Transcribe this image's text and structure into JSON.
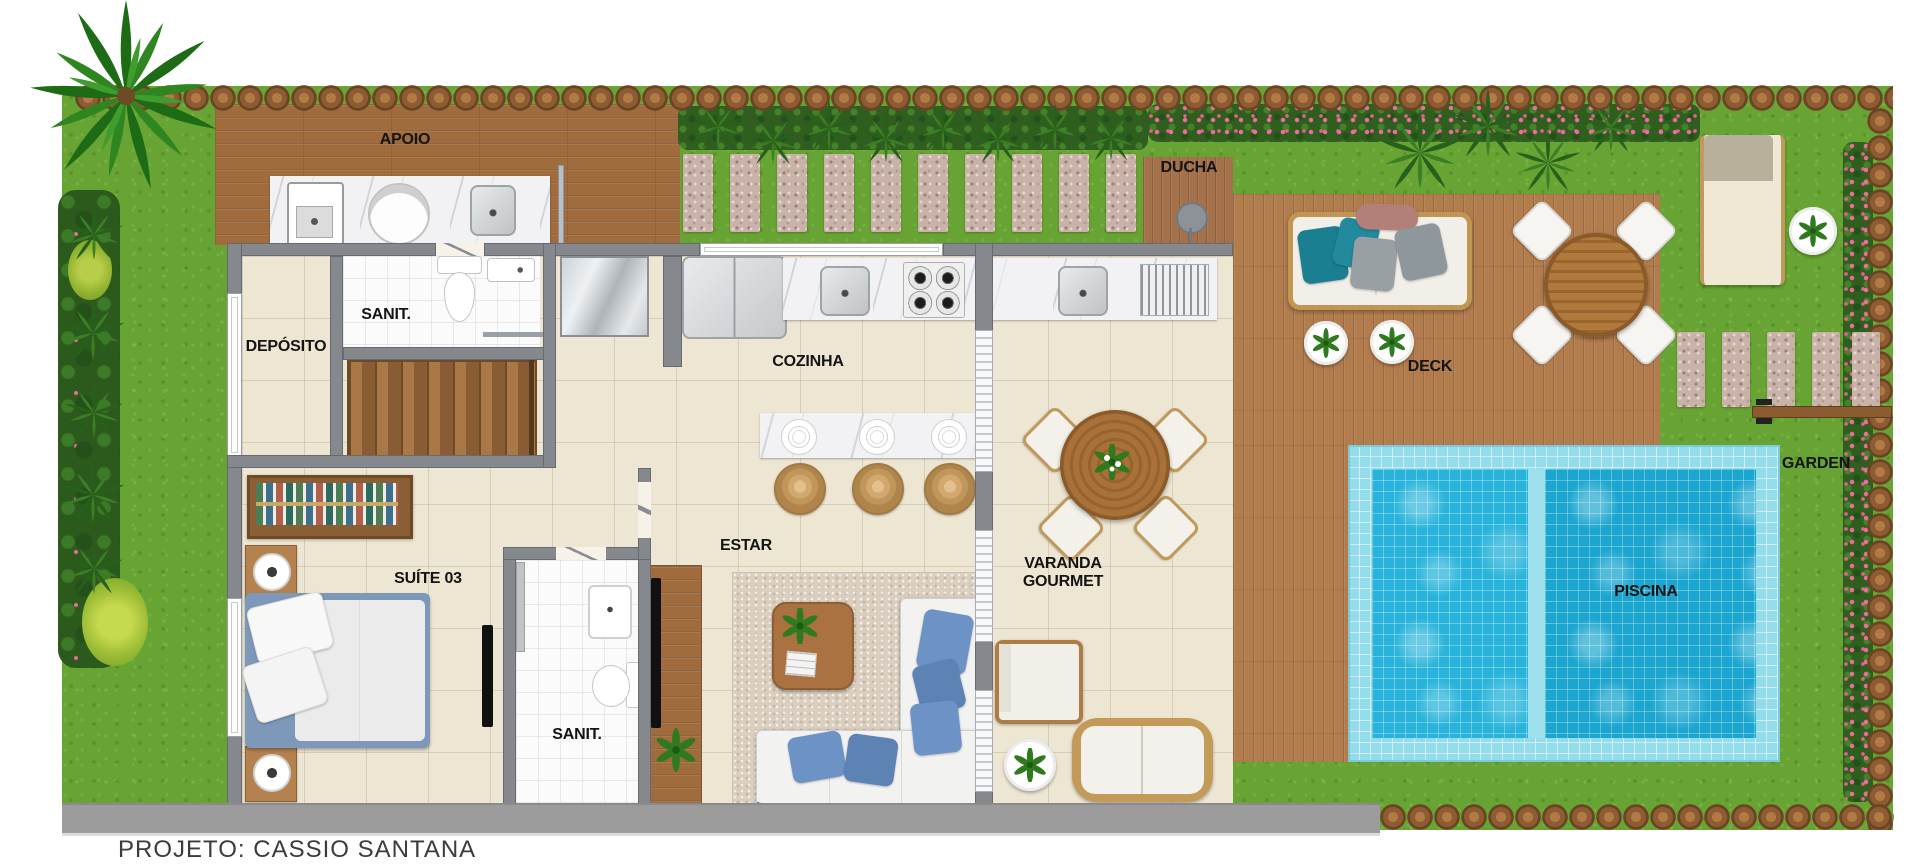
{
  "labels": {
    "apoio": "APOIO",
    "ducha": "DUCHA",
    "sanit_service": "SANIT.",
    "deposito": "DEPÓSITO",
    "cozinha": "COZINHA",
    "estar": "ESTAR",
    "suite03": "SUÍTE 03",
    "sanit_suite": "SANIT.",
    "varanda_1": "VARANDA",
    "varanda_2": "GOURMET",
    "deck": "DECK",
    "garden": "GARDEN",
    "piscina": "PISCINA"
  },
  "footer": {
    "credit": "PROJETO: CASSIO SANTANA"
  },
  "colors": {
    "grass": "#68a433",
    "deck_wood": "#b27c4d",
    "pool_water": "#28b4da",
    "pool_water_dark": "#1ba6cf",
    "wall_gray": "#85898d",
    "floor_cream": "#ede6d3",
    "label_ink": "#141414",
    "flower_pink": "#ec6f96",
    "pillow_blue": "#6d92c6",
    "pillow_teal": "#1b7f92"
  }
}
